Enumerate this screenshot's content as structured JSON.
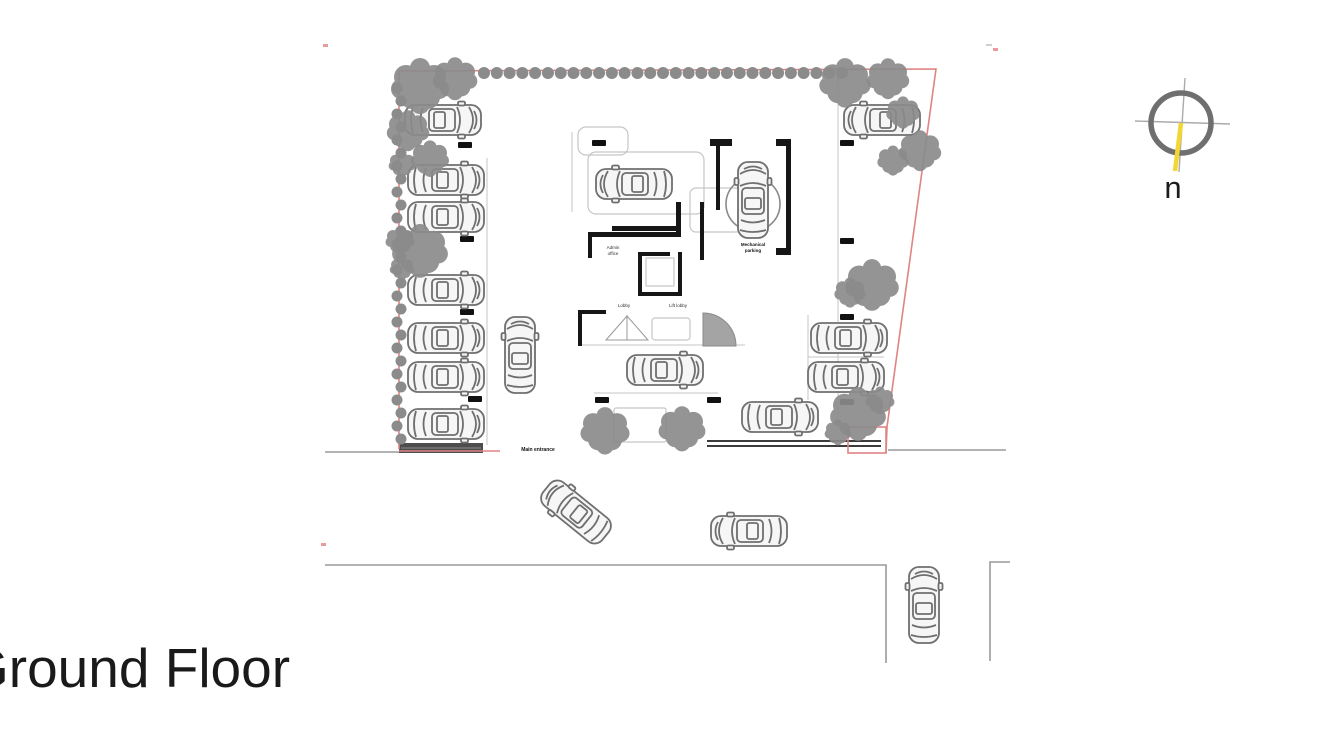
{
  "title": {
    "text": "Ground Floor"
  },
  "compass": {
    "label": "n",
    "cx": 1181,
    "cy": 123,
    "r": 30,
    "ring_color": "#6f6f6f",
    "cross_color": "#ababab",
    "needle_color": "#f2d732",
    "label_color": "#1b1b1b"
  },
  "colors": {
    "boundary": "#e08383",
    "road": "#9a9a9a",
    "tree": "#8b8b8b",
    "car": "#6f6f6f",
    "car_fill": "#f6f6f6",
    "wall": "#161616",
    "light": "#c6c6c6",
    "fence": "#3c3c3c",
    "bump": "#4d4d4d",
    "label": "#2e2e2e",
    "tick": "#111111"
  },
  "plan": {
    "boundary_polylines": [
      [
        [
          399,
          71
        ],
        [
          936,
          69
        ],
        [
          887,
          427
        ],
        [
          886,
          453
        ]
      ],
      [
        [
          399,
          71
        ],
        [
          399,
          449
        ]
      ],
      [
        [
          399,
          451
        ],
        [
          500,
          451
        ]
      ]
    ],
    "boundary_rect": [
      848,
      427,
      38,
      26
    ],
    "red_marks": [
      [
        323,
        44
      ],
      [
        321,
        543
      ],
      [
        993,
        48
      ]
    ],
    "gray_marks": [
      [
        986,
        44
      ]
    ],
    "roads": [
      [
        [
          325,
          452
        ],
        [
          399,
          452
        ]
      ],
      [
        [
          888,
          450
        ],
        [
          1006,
          450
        ]
      ],
      [
        [
          325,
          565
        ],
        [
          886,
          565
        ],
        [
          886,
          663
        ]
      ],
      [
        [
          1010,
          562
        ],
        [
          990,
          562
        ],
        [
          990,
          661
        ]
      ]
    ],
    "fence": {
      "x1": 707,
      "x2": 881,
      "y1": 441,
      "y2": 446
    },
    "speed_bump": [
      399,
      443,
      84,
      10
    ],
    "hedge": {
      "y": 73,
      "x1": 484,
      "x2": 842,
      "count": 29,
      "r": 6
    },
    "bushes": {
      "x": 399,
      "y1": 88,
      "y2": 440,
      "step": 13,
      "r": 5.5
    },
    "trees": [
      [
        420,
        85,
        26
      ],
      [
        455,
        78,
        20
      ],
      [
        408,
        130,
        19
      ],
      [
        430,
        158,
        17
      ],
      [
        402,
        164,
        12
      ],
      [
        420,
        250,
        25
      ],
      [
        400,
        240,
        13
      ],
      [
        402,
        268,
        11
      ],
      [
        845,
        82,
        23
      ],
      [
        888,
        78,
        19
      ],
      [
        903,
        112,
        15
      ],
      [
        920,
        150,
        19
      ],
      [
        893,
        160,
        14
      ],
      [
        872,
        284,
        24
      ],
      [
        850,
        292,
        14
      ],
      [
        858,
        413,
        25
      ],
      [
        880,
        400,
        13
      ],
      [
        838,
        432,
        12
      ],
      [
        605,
        430,
        22
      ],
      [
        682,
        428,
        21
      ]
    ],
    "cars": [
      [
        443,
        120,
        0
      ],
      [
        446,
        180,
        0
      ],
      [
        446,
        217,
        0
      ],
      [
        446,
        290,
        0
      ],
      [
        446,
        338,
        0
      ],
      [
        446,
        377,
        0
      ],
      [
        446,
        424,
        0
      ],
      [
        882,
        120,
        180
      ],
      [
        520,
        355,
        -90
      ],
      [
        634,
        184,
        180
      ],
      [
        753,
        200,
        -90
      ],
      [
        665,
        370,
        0
      ],
      [
        849,
        338,
        0
      ],
      [
        846,
        377,
        0
      ],
      [
        780,
        417,
        0
      ],
      [
        576,
        512,
        219
      ],
      [
        749,
        531,
        180
      ],
      [
        924,
        605,
        -90
      ]
    ],
    "turntable": {
      "x": 753,
      "y": 204,
      "r": 27
    },
    "light_lines": [
      [
        487,
        158,
        487,
        445
      ],
      [
        838,
        76,
        838,
        428
      ],
      [
        808,
        315,
        808,
        400
      ],
      [
        808,
        357,
        884,
        357
      ],
      [
        578,
        345,
        745,
        345
      ],
      [
        572,
        132,
        572,
        212
      ],
      [
        594,
        393,
        718,
        393
      ]
    ],
    "light_rects": [
      [
        578,
        127,
        50,
        28,
        8
      ],
      [
        588,
        152,
        116,
        62,
        8
      ],
      [
        690,
        188,
        52,
        44,
        6
      ],
      [
        652,
        318,
        38,
        22,
        3
      ],
      [
        646,
        258,
        28,
        28,
        1
      ],
      [
        614,
        408,
        52,
        34,
        2
      ]
    ],
    "walls": [
      [
        612,
        226,
        68,
        5
      ],
      [
        588,
        232,
        66,
        5
      ],
      [
        588,
        232,
        4,
        26
      ],
      [
        676,
        202,
        5,
        35
      ],
      [
        652,
        232,
        29,
        5
      ],
      [
        700,
        202,
        4,
        58
      ],
      [
        710,
        139,
        22,
        7
      ],
      [
        716,
        146,
        4,
        64
      ],
      [
        786,
        139,
        5,
        116
      ],
      [
        776,
        139,
        15,
        7
      ],
      [
        776,
        248,
        15,
        7
      ],
      [
        638,
        252,
        4,
        44
      ],
      [
        638,
        292,
        44,
        4
      ],
      [
        678,
        252,
        4,
        44
      ],
      [
        638,
        252,
        32,
        4
      ],
      [
        578,
        310,
        28,
        4
      ],
      [
        578,
        310,
        4,
        36
      ]
    ],
    "door_triangles": [
      [
        [
          606,
          340
        ],
        [
          627,
          316
        ],
        [
          627,
          340
        ]
      ],
      [
        [
          648,
          340
        ],
        [
          627,
          316
        ],
        [
          627,
          340
        ]
      ]
    ],
    "stair_fan": "M703,346 L703,313 A33,33 0 0 1 736,346 Z",
    "ticks": [
      [
        458,
        142
      ],
      [
        460,
        236
      ],
      [
        460,
        309
      ],
      [
        468,
        396
      ],
      [
        592,
        140
      ],
      [
        840,
        140
      ],
      [
        840,
        238
      ],
      [
        840,
        314
      ],
      [
        840,
        399
      ],
      [
        595,
        397
      ],
      [
        707,
        397
      ]
    ],
    "labels": [
      {
        "x": 613,
        "y": 249,
        "t": "Admin",
        "s": 4.5,
        "b": false
      },
      {
        "x": 613,
        "y": 255,
        "t": "office",
        "s": 4.5,
        "b": false
      },
      {
        "x": 624,
        "y": 307,
        "t": "Lobby",
        "s": 4.5,
        "b": false
      },
      {
        "x": 678,
        "y": 307,
        "t": "Lift lobby",
        "s": 4.5,
        "b": false
      },
      {
        "x": 753,
        "y": 246,
        "t": "Mechanical",
        "s": 4.5,
        "b": true
      },
      {
        "x": 753,
        "y": 252,
        "t": "parking",
        "s": 4.5,
        "b": true
      },
      {
        "x": 538,
        "y": 451,
        "t": "Main entrance",
        "s": 5,
        "b": true
      }
    ]
  }
}
